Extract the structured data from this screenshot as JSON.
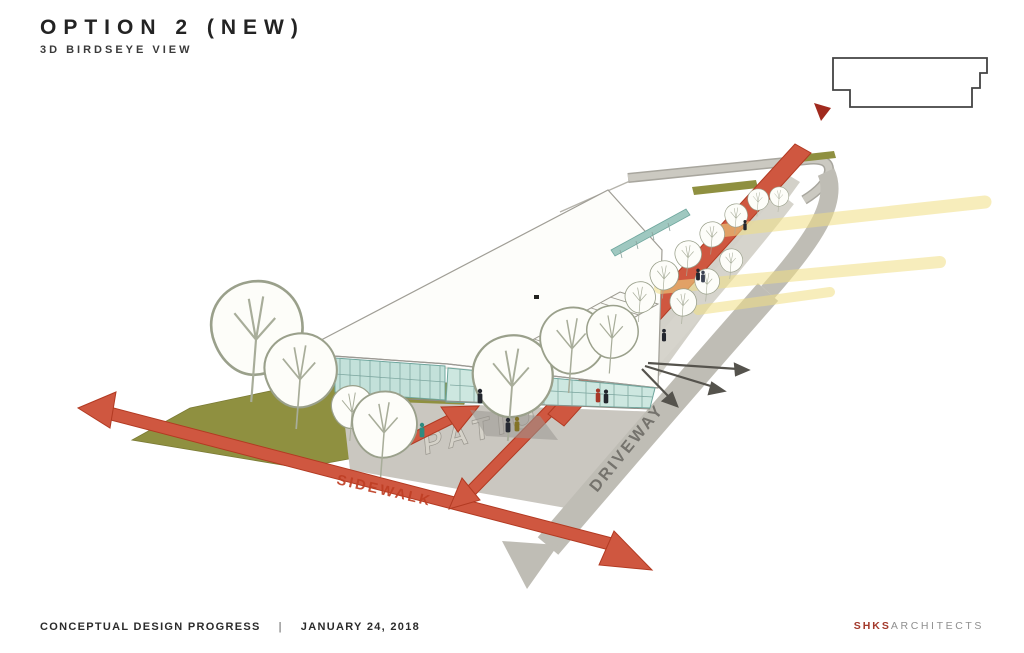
{
  "header": {
    "title": "OPTION 2 (NEW)",
    "subtitle": "3D BIRDSEYE VIEW"
  },
  "annotations": {
    "patio": "PATIO",
    "sidewalk": "SIDEWALK",
    "driveway": "DRIVEWAY"
  },
  "footer": {
    "status": "CONCEPTUAL DESIGN PROGRESS",
    "separator": "|",
    "date": "JANUARY 24, 2018"
  },
  "brand": {
    "name": "SHKS",
    "suffix": "ARCHITECTS"
  },
  "palette": {
    "arrow_red": "#cf5740",
    "arrow_red_edge": "#b23a22",
    "beam_yellow": "#f1df85",
    "lawn_olive": "#8f9040",
    "patio_gray": "#cac7c0",
    "driveway_gray": "#bfbdb5",
    "glass_teal": "#c3e1da",
    "brand_red": "#a3392b",
    "marker_red": "#a12a1e"
  }
}
